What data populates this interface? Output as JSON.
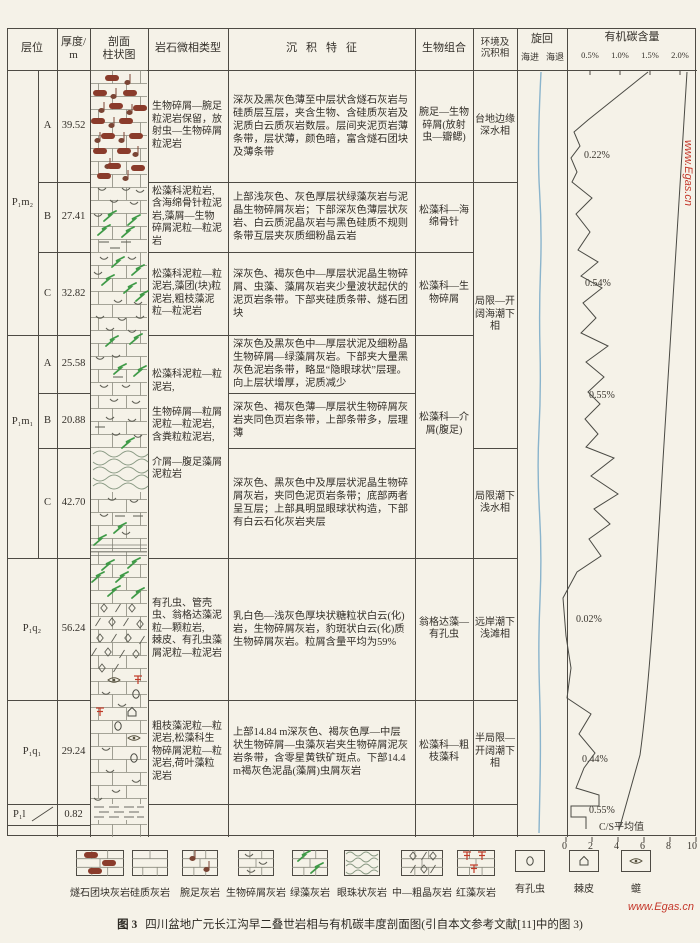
{
  "header": {
    "col_strata": "层位",
    "col_thickness": "厚度/\nm",
    "col_column": "剖面\n柱状图",
    "col_microfacies": "岩石微相类型",
    "col_features": "沉积特征",
    "col_bio": "生物组合",
    "col_env": "环境及\n沉积相",
    "col_cycle": "旋回",
    "cycle_in": "海进",
    "cycle_out": "海退",
    "col_toc": "有机碳含量",
    "toc_ticks": [
      "0.5%",
      "1.0%",
      "1.5%",
      "2.0%"
    ]
  },
  "strata": {
    "formations": [
      {
        "label": "P₁m₂"
      },
      {
        "label": "P₁m₁"
      },
      {
        "label": "P₁q₂"
      },
      {
        "label": "P₁q₁"
      },
      {
        "label": "P₁l"
      }
    ],
    "members": [
      "A",
      "B",
      "C",
      "A",
      "B",
      "C"
    ],
    "thickness": [
      "39.52",
      "27.41",
      "32.82",
      "25.58",
      "20.88",
      "42.70",
      "56.24",
      "29.24",
      "0.82"
    ]
  },
  "microfacies": [
    "生物碎屑—腕足粒泥岩保留，放射虫—生物碎屑粒泥岩",
    "松藻科泥粒岩,含海绵骨针粒泥岩,藻屑—生物碎屑泥粒—粒泥岩",
    "松藻科泥粒—粒泥岩,藻团(块)粒泥岩,粗枝藻泥粒—粒泥岩",
    "松藻科泥粒—粒泥岩,\n\n生物碎屑—粒屑泥粒—粒泥岩,\n含粪粒粒泥岩,\n\n介屑—腹足藻屑泥粒岩",
    "有孔虫、管壳虫、翁格达藻泥粒—颗粒岩,\n棘皮、有孔虫藻屑泥粒—粒泥岩",
    "粗枝藻泥粒—粒泥岩,松藻科生物碎屑泥粒—粒泥岩,荷叶藻粒泥岩"
  ],
  "features": [
    "深灰及黑灰色薄至中层状含燧石灰岩与硅质层互层，夹含生物、含硅质灰岩及泥质白云质灰岩数层。层间夹泥页岩薄条带，层状薄，颜色暗，富含燧石团块及薄条带",
    "上部浅灰色、灰色厚层状绿藻灰岩与泥晶生物碎屑灰岩；下部深灰色薄层状灰岩、白云质泥晶灰岩与黑色硅质不规则条带互层夹灰质细粉晶云岩",
    "深灰色、褐灰色中—厚层状泥晶生物碎屑、虫藻、藻屑灰岩夹少量波状起伏的泥页岩条带。下部夹硅质条带、燧石团块",
    "深灰色及黑灰色中—厚层状泥及细粉晶生物碎屑—绿藻屑灰岩。下部夹大量黑灰色泥岩条带，略显“隐眼球状”层理。向上层状增厚，泥质减少",
    "深灰色、褐灰色薄—厚层状生物碎屑灰岩夹同色页岩条带，上部条带多，层理薄",
    "深灰色、黑灰色中及厚层状泥晶生物碎屑灰岩，夹同色泥页岩条带；底部两者呈互层；上部具明显眼球状构造，下部有白云石化灰岩夹层",
    "乳白色—浅灰色厚块状糖粒状白云(化)岩，生物碎屑灰岩，豹斑状白云(化)质生物碎屑灰岩。粒屑含量平均为59%",
    "上部14.84 m深灰色、褐灰色厚—中层状生物碎屑—虫藻灰岩夹生物碎屑泥灰岩条带，含零星黄铁矿斑点。下部14.4 m褐灰色泥晶(藻屑)虫屑灰岩"
  ],
  "bio": [
    "腕足—生物碎屑(放射虫—瓣鳃)",
    "松藻科—海绵骨针",
    "松藻科—生物碎屑",
    "松藻科—介屑(腹足)",
    "翁格达藻—有孔虫",
    "松藻科—粗枝藻科"
  ],
  "env": [
    "台地边缘深水相",
    "局限—开阔海潮下相",
    "局限潮下浅水相",
    "远岸潮下浅滩相",
    "半局限—开阔潮下相"
  ],
  "toc_values": [
    "0.22%",
    "0.54%",
    "0.55%",
    "0.02%",
    "0.44%",
    "0.55%"
  ],
  "cs_label": "C/S平均值",
  "bottom_ticks": [
    "0",
    "2",
    "4",
    "6",
    "8",
    "10"
  ],
  "legend": [
    {
      "label": "燧石团块灰岩",
      "pattern": "chert-nodule-limestone"
    },
    {
      "label": "硅质灰岩",
      "pattern": "siliceous-limestone"
    },
    {
      "label": "腕足灰岩",
      "pattern": "brachiopod-limestone"
    },
    {
      "label": "生物碎屑灰岩",
      "pattern": "bioclastic-limestone"
    },
    {
      "label": "绿藻灰岩",
      "pattern": "green-algae-limestone"
    },
    {
      "label": "眼珠状灰岩",
      "pattern": "eyeball-limestone"
    },
    {
      "label": "中—粗晶灰岩",
      "pattern": "medium-coarse-crystalline-limestone"
    },
    {
      "label": "红藻灰岩",
      "pattern": "red-algae-limestone"
    },
    {
      "label": "有孔虫",
      "pattern": "foraminifera"
    },
    {
      "label": "棘皮",
      "pattern": "echinoderm"
    },
    {
      "label": "䗴",
      "pattern": "fusulinid"
    }
  ],
  "caption": {
    "fig": "图 3",
    "text": "四川盆地广元长江沟早二叠世岩相与有机碳丰度剖面图(引自本文参考文献[11]中的图 3)"
  },
  "watermark": "www.Egas.cn",
  "chart_data": {
    "type": "line",
    "title": "有机碳含量",
    "x_axis_top": {
      "label": "有机碳含量",
      "ticks": [
        "0.5%",
        "1.0%",
        "1.5%",
        "2.0%"
      ]
    },
    "x_axis_bottom": {
      "label": "C/S平均值",
      "ticks": [
        0,
        2,
        4,
        6,
        8,
        10
      ]
    },
    "cycle_curve": "海进—海退旋回曲线",
    "units": [
      {
        "formation": "P₁m₂",
        "member": "A",
        "thickness_m": 39.52,
        "toc": "0.22%",
        "env": "台地边缘深水相"
      },
      {
        "formation": "P₁m₂",
        "member": "B",
        "thickness_m": 27.41,
        "toc": null,
        "env": "局限—开阔海潮下相"
      },
      {
        "formation": "P₁m₂",
        "member": "C",
        "thickness_m": 32.82,
        "toc": "0.54%",
        "env": "局限—开阔海潮下相"
      },
      {
        "formation": "P₁m₁",
        "member": "A",
        "thickness_m": 25.58,
        "toc": null,
        "env": "局限—开阔海潮下相"
      },
      {
        "formation": "P₁m₁",
        "member": "B",
        "thickness_m": 20.88,
        "toc": "0.55%",
        "env": "局限—开阔海潮下相"
      },
      {
        "formation": "P₁m₁",
        "member": "C",
        "thickness_m": 42.7,
        "toc": null,
        "env": "局限潮下浅水相"
      },
      {
        "formation": "P₁q₂",
        "member": null,
        "thickness_m": 56.24,
        "toc": "0.02%",
        "env": "远岸潮下浅滩相"
      },
      {
        "formation": "P₁q₁",
        "member": null,
        "thickness_m": 29.24,
        "toc": "0.44%",
        "env": "半局限—开阔潮下相"
      },
      {
        "formation": "P₁l",
        "member": null,
        "thickness_m": 0.82,
        "toc": "0.55%",
        "env": null
      }
    ],
    "toc_polyline_px": [
      [
        648,
        72
      ],
      [
        588,
        120
      ],
      [
        574,
        132
      ],
      [
        580,
        146
      ],
      [
        571,
        158
      ],
      [
        577,
        172
      ],
      [
        572,
        182
      ],
      [
        592,
        198
      ],
      [
        576,
        214
      ],
      [
        590,
        232
      ],
      [
        578,
        250
      ],
      [
        598,
        262
      ],
      [
        581,
        276
      ],
      [
        602,
        288
      ],
      [
        583,
        303
      ],
      [
        596,
        318
      ],
      [
        581,
        333
      ],
      [
        608,
        346
      ],
      [
        586,
        362
      ],
      [
        604,
        377
      ],
      [
        588,
        392
      ],
      [
        600,
        404
      ],
      [
        585,
        419
      ],
      [
        598,
        434
      ],
      [
        586,
        447
      ],
      [
        614,
        458
      ],
      [
        591,
        476
      ],
      [
        618,
        494
      ],
      [
        594,
        509
      ],
      [
        610,
        524
      ],
      [
        589,
        539
      ],
      [
        601,
        556
      ],
      [
        577,
        572
      ],
      [
        563,
        598
      ],
      [
        566,
        636
      ],
      [
        571,
        668
      ],
      [
        567,
        698
      ],
      [
        591,
        714
      ],
      [
        579,
        734
      ],
      [
        595,
        753
      ],
      [
        584,
        768
      ],
      [
        576,
        788
      ],
      [
        599,
        795
      ],
      [
        599,
        806
      ],
      [
        571,
        806
      ],
      [
        571,
        817
      ],
      [
        586,
        817
      ],
      [
        586,
        829
      ]
    ],
    "cs_curve_px": "M687,72 C679,210 671,340 663,460 C656,580 649,690 640,755 L619,830",
    "cycle_px": [
      [
        541,
        72
      ],
      [
        537,
        150
      ],
      [
        542,
        230
      ],
      [
        539,
        310
      ],
      [
        541,
        390
      ],
      [
        537,
        470
      ],
      [
        542,
        555
      ],
      [
        538,
        645
      ],
      [
        541,
        735
      ],
      [
        539,
        833
      ]
    ]
  },
  "lithology": {
    "segments": [
      {
        "name": "chert-brachiopod-limestone",
        "symbols": [
          [
            "chert",
            112,
            78
          ],
          [
            "note",
            128,
            80
          ],
          [
            "chert",
            100,
            93
          ],
          [
            "note",
            114,
            94
          ],
          [
            "chert",
            130,
            93
          ],
          [
            "chert",
            116,
            106
          ],
          [
            "note",
            102,
            108
          ],
          [
            "chert",
            140,
            108
          ],
          [
            "note",
            130,
            110
          ],
          [
            "chert",
            98,
            121
          ],
          [
            "chert",
            126,
            121
          ],
          [
            "note",
            112,
            123
          ],
          [
            "chert",
            108,
            136
          ],
          [
            "note",
            98,
            138
          ],
          [
            "chert",
            136,
            136
          ],
          [
            "note",
            122,
            138
          ],
          [
            "chert",
            100,
            151
          ],
          [
            "chert",
            124,
            151
          ],
          [
            "note",
            136,
            152
          ],
          [
            "note",
            108,
            164
          ],
          [
            "chert",
            114,
            166
          ],
          [
            "chert",
            138,
            168
          ],
          [
            "chert",
            104,
            176
          ],
          [
            "note",
            126,
            176
          ]
        ]
      },
      {
        "name": "bioclast-algae-limestone",
        "symbols": [
          [
            "v",
            102,
            188
          ],
          [
            "v",
            126,
            188
          ],
          [
            "v",
            140,
            190
          ],
          [
            "v",
            114,
            200
          ],
          [
            "v",
            134,
            202
          ],
          [
            "v",
            98,
            214
          ],
          [
            "algae",
            110,
            216
          ],
          [
            "algae",
            134,
            220
          ],
          [
            "algae",
            104,
            230
          ],
          [
            "algae",
            128,
            232
          ],
          [
            "dash",
            104,
            242
          ],
          [
            "dash",
            126,
            242
          ],
          [
            "dash",
            115,
            248
          ]
        ]
      },
      {
        "name": "algae-bioclast-limestone",
        "symbols": [
          [
            "v",
            104,
            257
          ],
          [
            "v",
            132,
            257
          ],
          [
            "algae",
            118,
            262
          ],
          [
            "algae",
            138,
            270
          ],
          [
            "v",
            98,
            272
          ],
          [
            "algae",
            108,
            280
          ],
          [
            "algae",
            130,
            288
          ],
          [
            "v",
            118,
            300
          ],
          [
            "algae",
            142,
            296
          ],
          [
            "v",
            138,
            302
          ],
          [
            "v",
            100,
            316
          ],
          [
            "v",
            122,
            318
          ],
          [
            "v",
            140,
            316
          ],
          [
            "v",
            110,
            328
          ],
          [
            "v",
            132,
            330
          ]
        ]
      },
      {
        "name": "green-algae-limestone",
        "symbols": [
          [
            "algae",
            112,
            341
          ],
          [
            "algae",
            136,
            339
          ],
          [
            "v",
            116,
            355
          ],
          [
            "v",
            100,
            357
          ],
          [
            "algae",
            120,
            369
          ],
          [
            "algae",
            140,
            371
          ],
          [
            "dash",
            118,
            377
          ],
          [
            "v",
            104,
            385
          ],
          [
            "v",
            126,
            385
          ]
        ]
      },
      {
        "name": "bioclastic-limestone",
        "symbols": [
          [
            "v",
            114,
            399
          ],
          [
            "v",
            136,
            401
          ],
          [
            "v",
            110,
            417
          ],
          [
            "v",
            132,
            419
          ],
          [
            "dash",
            100,
            427
          ],
          [
            "v",
            116,
            433
          ],
          [
            "v",
            138,
            435
          ],
          [
            "algae",
            128,
            443
          ]
        ]
      },
      {
        "name": "eyeball-then-bioclast",
        "symbols": [
          [
            "v",
            112,
            498
          ],
          [
            "v",
            134,
            500
          ],
          [
            "v",
            104,
            514
          ],
          [
            "dash",
            120,
            516
          ],
          [
            "dash",
            138,
            516
          ],
          [
            "algae",
            120,
            528
          ],
          [
            "v",
            126,
            532
          ],
          [
            "algae",
            100,
            540
          ]
        ]
      },
      {
        "name": "dolomitized-crystalline",
        "symbols": [
          [
            "algae",
            108,
            565
          ],
          [
            "algae",
            134,
            563
          ],
          [
            "algae",
            98,
            577
          ],
          [
            "algae",
            122,
            577
          ],
          [
            "algae",
            114,
            591
          ],
          [
            "algae",
            138,
            593
          ],
          [
            "dia",
            104,
            608
          ],
          [
            "sla",
            118,
            608
          ],
          [
            "dia",
            132,
            608
          ],
          [
            "sla",
            98,
            622
          ],
          [
            "dia",
            112,
            622
          ],
          [
            "sla",
            126,
            622
          ],
          [
            "dia",
            140,
            624
          ],
          [
            "dia",
            100,
            638
          ],
          [
            "sla",
            114,
            638
          ],
          [
            "dia",
            128,
            638
          ],
          [
            "sla",
            142,
            640
          ],
          [
            "dia",
            108,
            652
          ],
          [
            "sla",
            122,
            654
          ],
          [
            "dia",
            136,
            654
          ],
          [
            "sla",
            94,
            652
          ],
          [
            "dia",
            102,
            668
          ],
          [
            "sla",
            116,
            668
          ],
          [
            "fus",
            114,
            680
          ],
          [
            "red",
            138,
            680
          ],
          [
            "v",
            106,
            692
          ],
          [
            "foram",
            136,
            694
          ],
          [
            "v",
            122,
            704
          ],
          [
            "red",
            100,
            712
          ],
          [
            "ech",
            132,
            712
          ]
        ]
      },
      {
        "name": "foram-fusulinid-limestone",
        "symbols": [
          [
            "foram",
            118,
            726
          ],
          [
            "fus",
            134,
            738
          ],
          [
            "v",
            106,
            748
          ],
          [
            "foram",
            134,
            758
          ],
          [
            "v",
            110,
            770
          ],
          [
            "v",
            136,
            780
          ],
          [
            "v",
            116,
            790
          ],
          [
            "v",
            98,
            798
          ]
        ]
      }
    ]
  }
}
